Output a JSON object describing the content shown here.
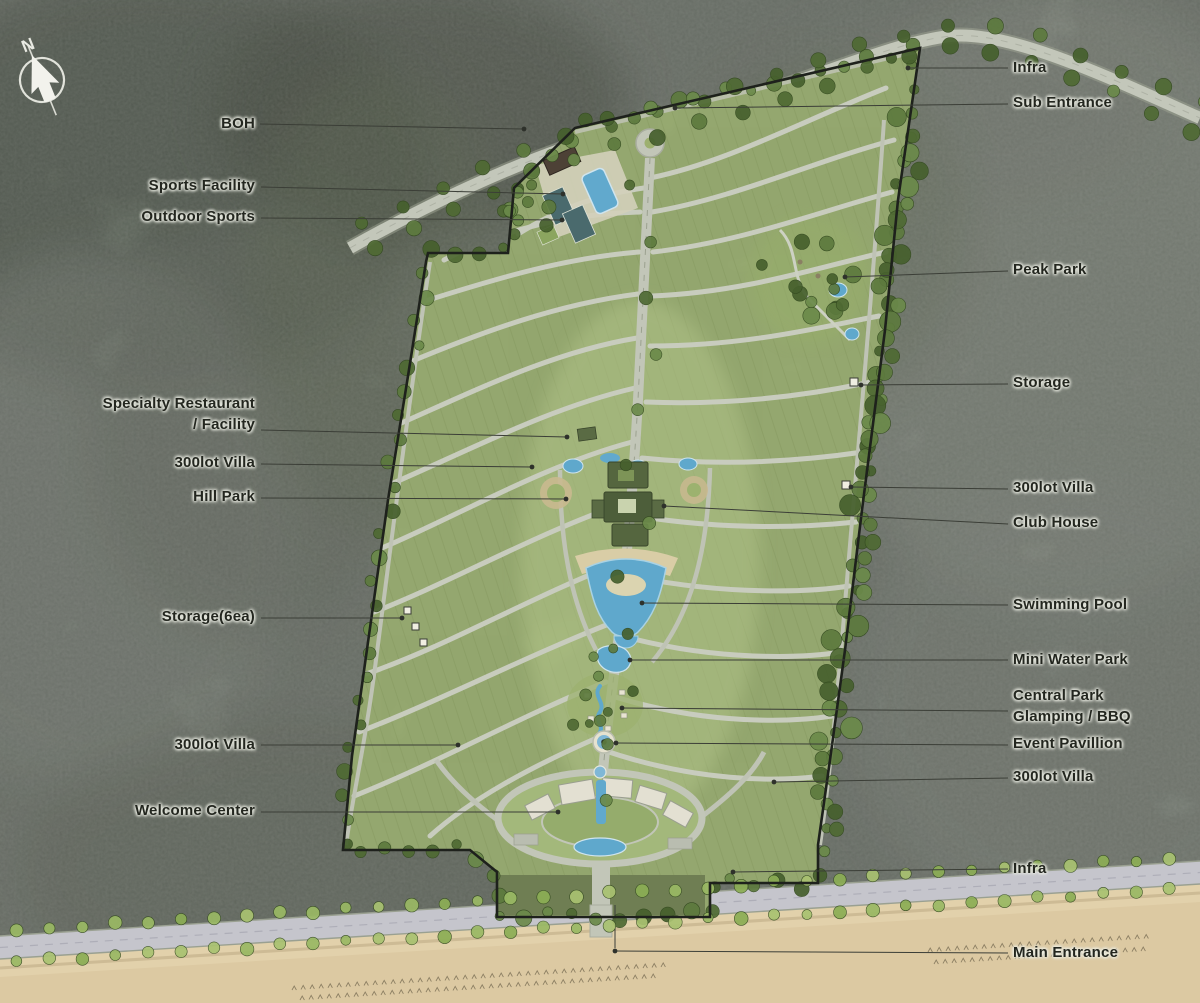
{
  "compass": {
    "letter": "N"
  },
  "palette": {
    "terrain": "#7e857b",
    "site_green": "#a5ba7c",
    "road": "#c6cabd",
    "water": "#5fa8cc",
    "sand": "#dcc9a2",
    "boundary": "#1e211c",
    "label_text": "#23261f",
    "tree_green": "#5d7a3e"
  },
  "labels": {
    "left": [
      {
        "id": "boh",
        "text": "BOH"
      },
      {
        "id": "sports-facility",
        "text": "Sports Facility"
      },
      {
        "id": "outdoor-sports",
        "text": "Outdoor Sports"
      },
      {
        "id": "specialty-restaurant",
        "text": "Specialty Restaurant\n/ Facility"
      },
      {
        "id": "villa-300lot-upper",
        "text": "300lot Villa"
      },
      {
        "id": "hill-park",
        "text": "Hill Park"
      },
      {
        "id": "storage-6ea",
        "text": "Storage(6ea)"
      },
      {
        "id": "villa-300lot-lower",
        "text": "300lot Villa"
      },
      {
        "id": "welcome-center",
        "text": "Welcome Center"
      }
    ],
    "right": [
      {
        "id": "infra-top",
        "text": "Infra"
      },
      {
        "id": "sub-entrance",
        "text": "Sub Entrance"
      },
      {
        "id": "peak-park",
        "text": "Peak Park"
      },
      {
        "id": "storage",
        "text": "Storage"
      },
      {
        "id": "villa-300lot-upper",
        "text": "300lot Villa"
      },
      {
        "id": "club-house",
        "text": "Club House"
      },
      {
        "id": "swimming-pool",
        "text": "Swimming Pool"
      },
      {
        "id": "mini-water-park",
        "text": "Mini Water Park"
      },
      {
        "id": "central-park",
        "text": "Central Park\nGlamping / BBQ"
      },
      {
        "id": "event-pavillion",
        "text": "Event Pavillion"
      },
      {
        "id": "villa-300lot-lower",
        "text": "300lot Villa"
      },
      {
        "id": "infra-bottom",
        "text": "Infra"
      },
      {
        "id": "main-entrance",
        "text": "Main Entrance"
      }
    ]
  }
}
